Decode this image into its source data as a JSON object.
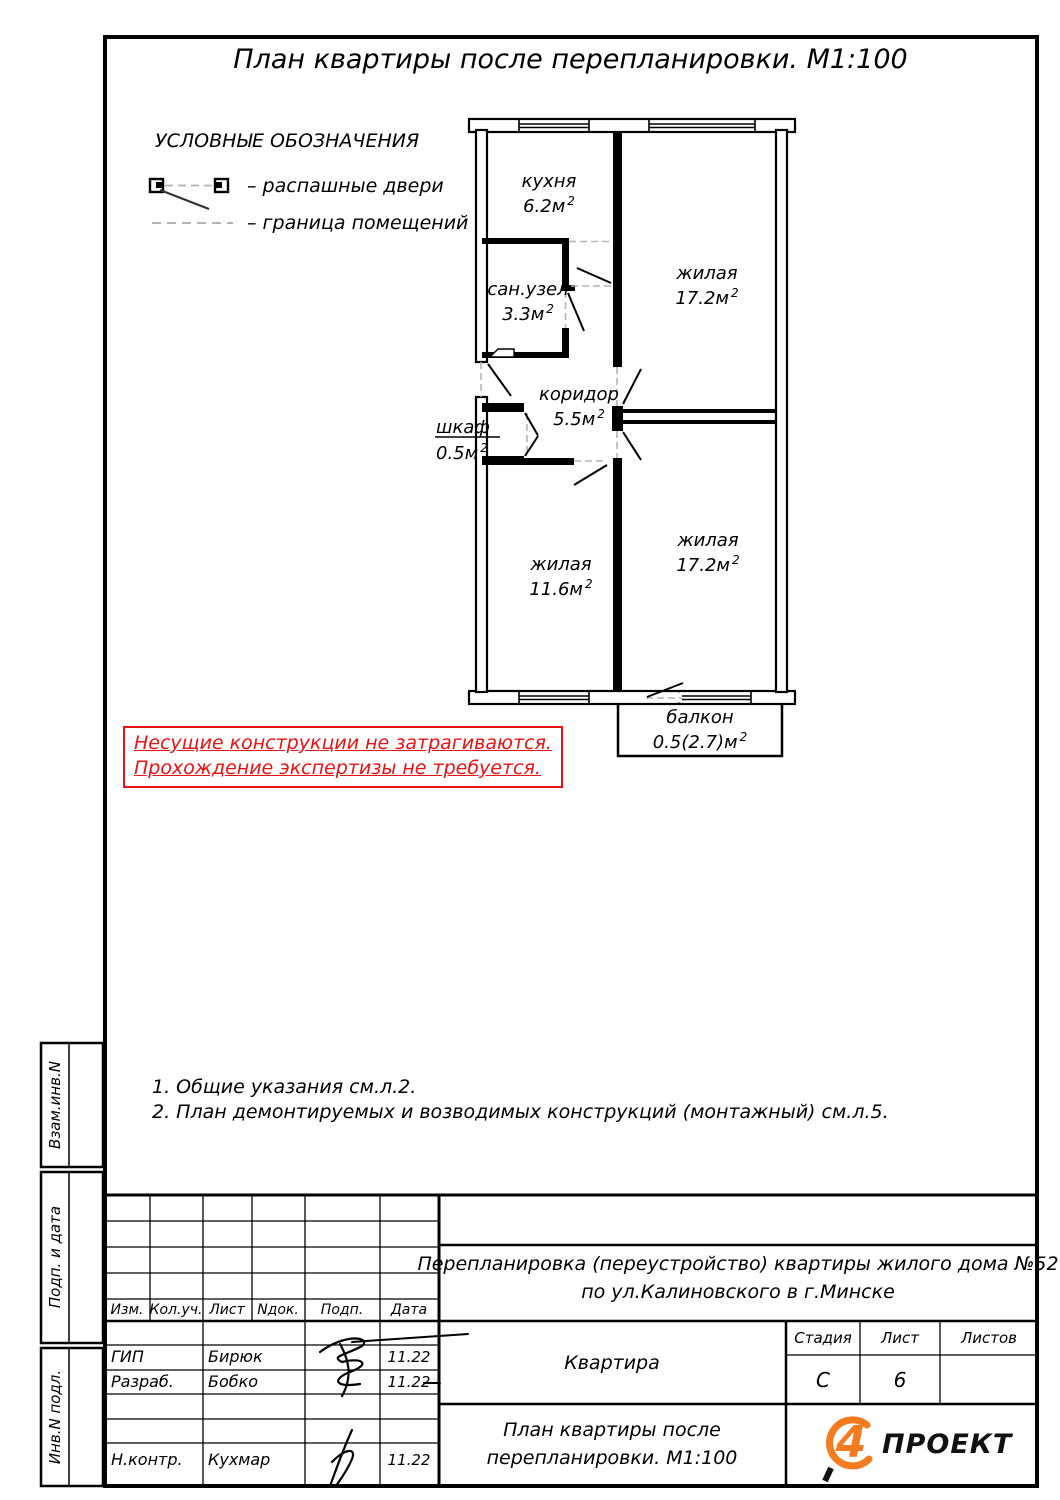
{
  "sheet": {
    "title": "План квартиры после перепланировки. М1:100"
  },
  "legend": {
    "heading": "УСЛОВНЫЕ ОБОЗНАЧЕНИЯ",
    "door_item": {
      "label": "– распашные двери"
    },
    "boundary_item": {
      "label": "– граница помещений"
    }
  },
  "plan": {
    "rooms": {
      "kitchen": {
        "name": "кухня",
        "area": "6.2м",
        "sup": "2"
      },
      "living_top": {
        "name": "жилая",
        "area": "17.2м",
        "sup": "2"
      },
      "bathroom": {
        "name": "сан.узел",
        "area": "3.3м",
        "sup": "2"
      },
      "corridor": {
        "name": "коридор",
        "area": "5.5м",
        "sup": "2"
      },
      "closet": {
        "name": "шкаф",
        "area": "0.5м",
        "sup": "2"
      },
      "living_left": {
        "name": "жилая",
        "area": "11.6м",
        "sup": "2"
      },
      "living_right": {
        "name": "жилая",
        "area": "17.2м",
        "sup": "2"
      },
      "balcony": {
        "name": "балкон",
        "area": "0.5(2.7)м",
        "sup": "2"
      }
    }
  },
  "warning": {
    "line1": "Несущие конструкции не затрагиваются.",
    "line2": "Прохождение экспертизы не требуется."
  },
  "notes": {
    "note1": "1. Общие указания см.л.2.",
    "note2": "2. План демонтируемых и возводимых конструкций (монтажный) см.л.5."
  },
  "sidebar": {
    "box1": "Взам.инв.N",
    "box2": "Подп. и дата",
    "box3": "Инв.N подл."
  },
  "titleblock": {
    "rev_headers": {
      "izm": "Изм.",
      "kol": "Кол.уч.",
      "list": "Лист",
      "ndok": "Nдок.",
      "podp": "Подп.",
      "data": "Дата"
    },
    "signers": {
      "gip": {
        "role": "ГИП",
        "name": "Бирюк",
        "date": "11.22"
      },
      "razrab": {
        "role": "Разраб.",
        "name": "Бобко",
        "date": "11.22"
      },
      "nkontr": {
        "role": "Н.контр.",
        "name": "Кухмар",
        "date": "11.22"
      }
    },
    "project_line1": "Перепланировка (переустройство) квартиры жилого дома №52",
    "project_line2": "по ул.Калиновского в г.Минске",
    "object_name": "Квартира",
    "stage_header": "Стадия",
    "sheet_header": "Лист",
    "sheets_header": "Листов",
    "stage_value": "С",
    "sheet_value": "6",
    "sheets_value": "",
    "drawing_line1": "План квартиры после",
    "drawing_line2": "перепланировки. М1:100",
    "logo": {
      "mark": "4",
      "text": "ПРОЕКТ"
    }
  },
  "colors": {
    "warning_red": "#e81313",
    "logo_orange": "#f47b20",
    "line_black": "#000000",
    "boundary_gray": "#b3b3b3"
  }
}
